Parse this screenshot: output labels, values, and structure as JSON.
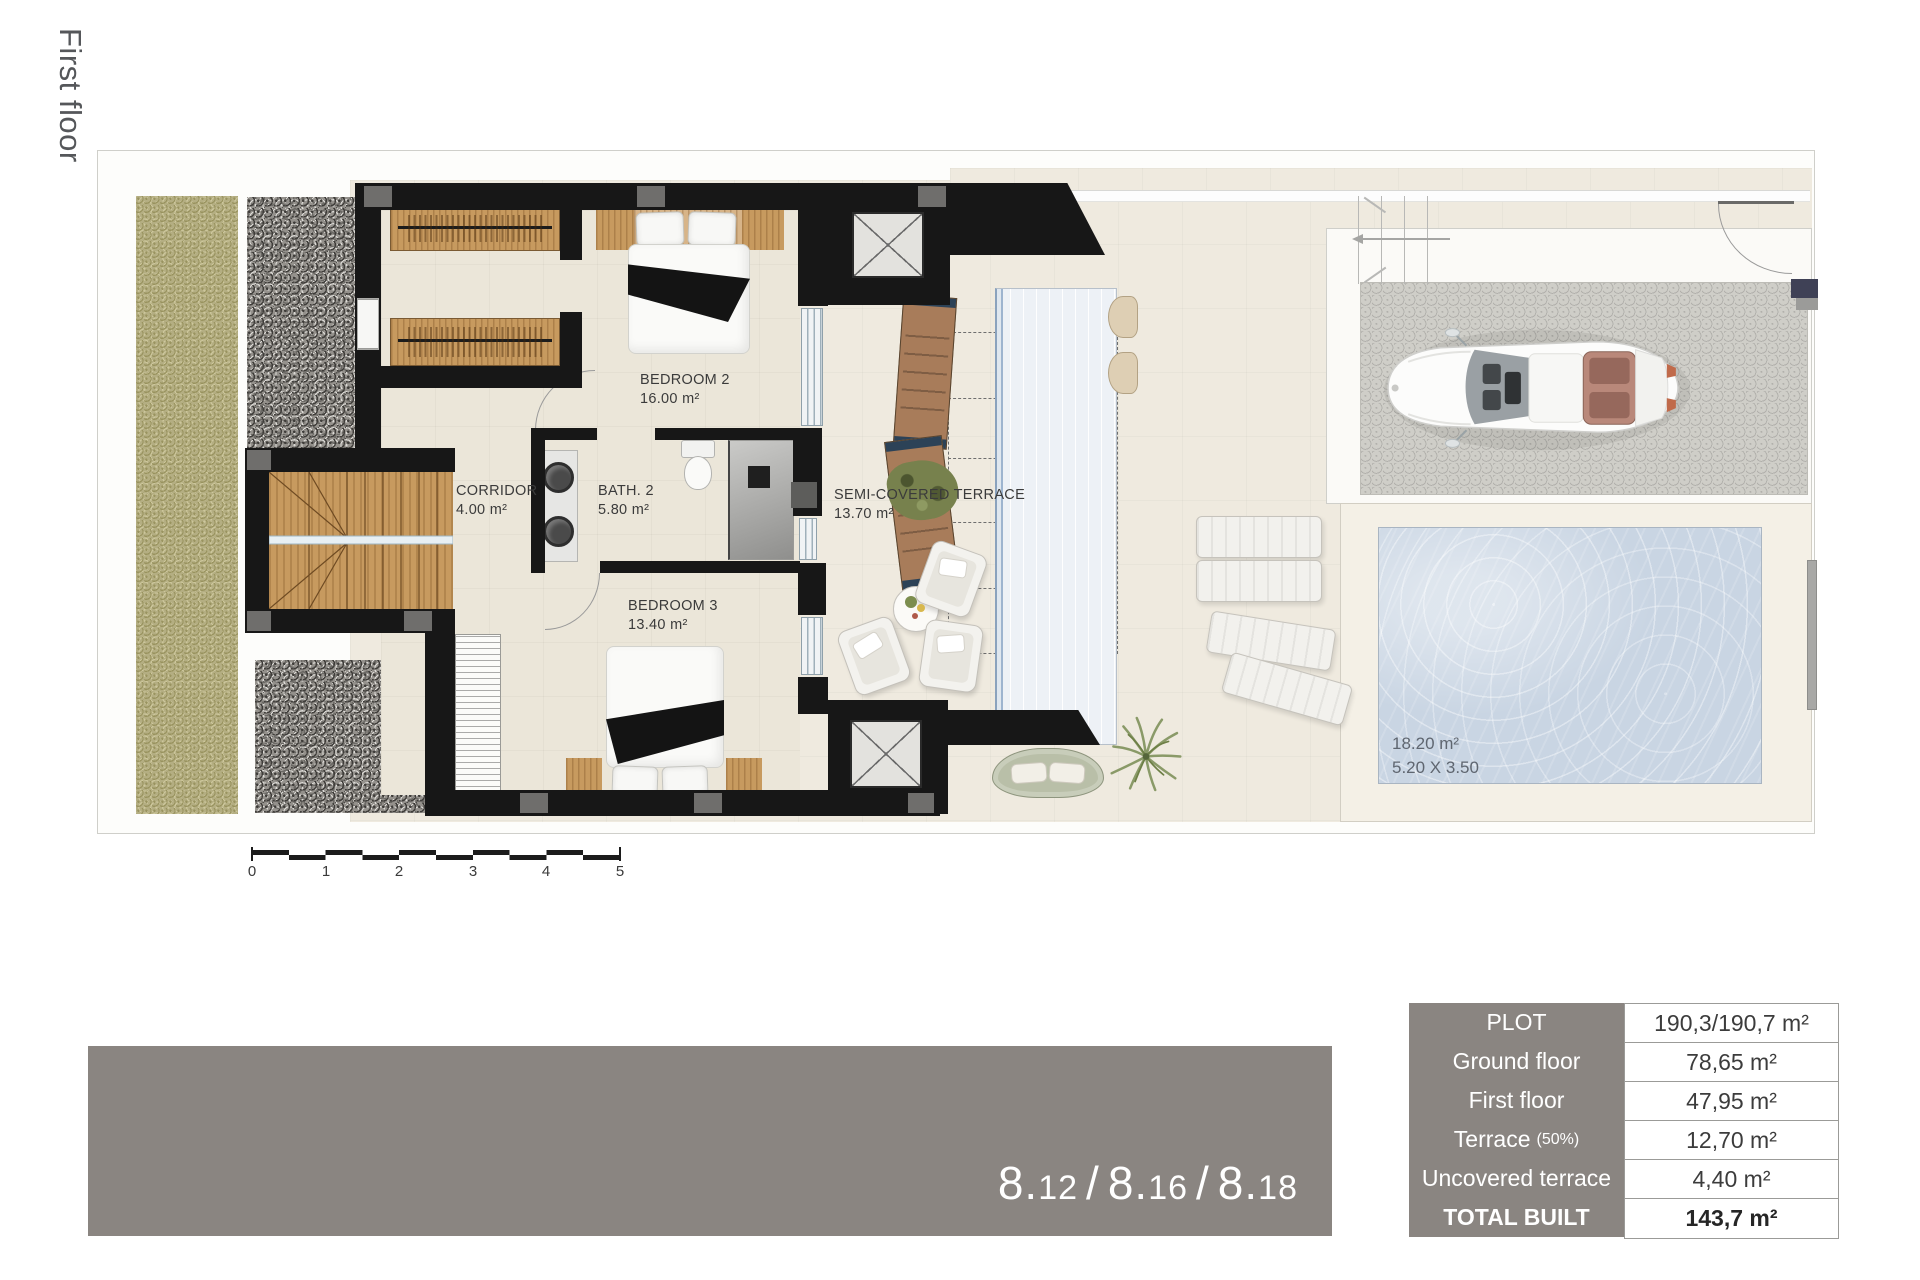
{
  "floor_label": "First floor",
  "plan": {
    "rooms": [
      {
        "id": "bedroom-2",
        "name": "BEDROOM 2",
        "area": "16.00 m²"
      },
      {
        "id": "corridor",
        "name": "CORRIDOR",
        "area": "4.00 m²"
      },
      {
        "id": "bath-2",
        "name": "BATH. 2",
        "area": "5.80 m²"
      },
      {
        "id": "bedroom-3",
        "name": "BEDROOM 3",
        "area": "13.40 m²"
      },
      {
        "id": "semi-covered-terrace",
        "name": "SEMI-COVERED TERRACE",
        "area": "13.70 m²"
      }
    ],
    "pool": {
      "area": "18.20 m²",
      "dimensions": "5.20 X 3.50"
    },
    "scale_bar": {
      "ticks": [
        "0",
        "1",
        "2",
        "3",
        "4",
        "5"
      ]
    }
  },
  "banner": {
    "text": "8.12 / 8.16 / 8.18",
    "units": [
      "8.12",
      "8.16",
      "8.18"
    ],
    "separator": "/",
    "bg_color": "#8a8581"
  },
  "summary_table": {
    "header_bg": "#8a8581",
    "rows": [
      {
        "label": "PLOT",
        "value": "190,3/190,7 m²"
      },
      {
        "label": "Ground floor",
        "value": "78,65 m²"
      },
      {
        "label": "First floor",
        "value": "47,95 m²"
      },
      {
        "label": "Terrace",
        "label_suffix": "(50%)",
        "value": "12,70 m²"
      },
      {
        "label": "Uncovered terrace",
        "value": "4,40 m²"
      },
      {
        "label": "TOTAL BUILT",
        "value": "143,7 m²",
        "emphasis": true
      }
    ]
  }
}
